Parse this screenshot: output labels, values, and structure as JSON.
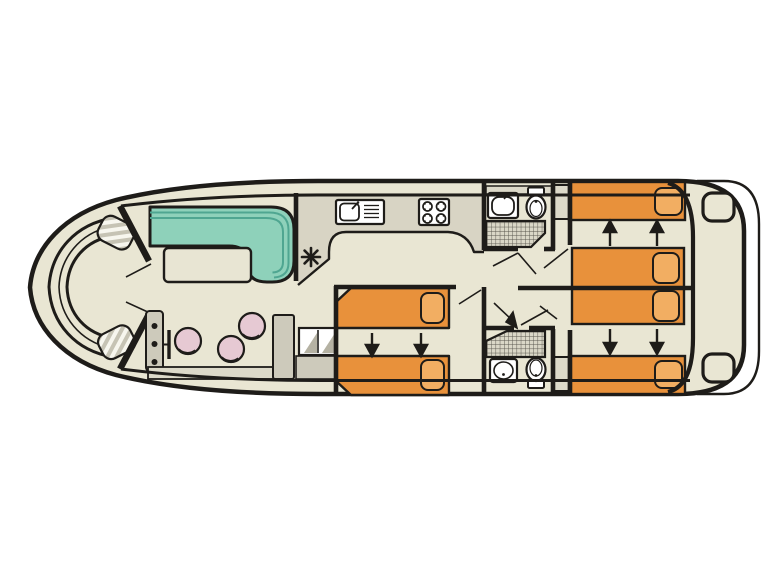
{
  "page": {
    "background": "#ffffff",
    "title": "houseboat-deck-plan"
  },
  "colors": {
    "outline": "#1e1c19",
    "floor": "#e9e6d3",
    "galley_floor": "#d8d4c4",
    "table": "#e8e5d3",
    "sofa": "#8ed1ba",
    "sofa_line": "#4fa691",
    "bed": "#e8913b",
    "pillow": "#f2ae62",
    "stool": "#e6c9d3",
    "gray": "#cdcabb",
    "gray_light": "#dcd9c9",
    "steps": "#b5b2a3",
    "fixture": "#ffffff",
    "hatch": "#55524a",
    "hatch_bg": "#dad7c7",
    "pad_stripe_a": "#c6c3b4",
    "pad_stripe_b": "#f7f6ee"
  },
  "plan": {
    "bow": {
      "seating": "c-shaped-bench",
      "fender_pads": 2,
      "entry_door_leaves": 2
    },
    "saloon": {
      "sofa_shape": "l-shaped",
      "tables": 1,
      "stools": 3,
      "helm_gauges": 3,
      "steering_wheel": 1,
      "sideboard": 1,
      "companionway_steps": 2
    },
    "galley": {
      "sinks": 1,
      "drainer_grooves": 4,
      "hob_burners": 4,
      "heater_symbol": "asterisk"
    },
    "bathrooms": [
      {
        "position": "forward",
        "washbasin": 1,
        "toilet": 1,
        "shower": "hatched-grid"
      },
      {
        "position": "aft",
        "washbasin": 1,
        "toilet": 1,
        "shower": "hatched-grid"
      }
    ],
    "cabins": [
      {
        "position": "midship-port",
        "beds": 2,
        "convert_arrows": "down",
        "arrow_count": 2
      },
      {
        "position": "aft-starboard",
        "beds": 2,
        "convert_arrows": "up",
        "arrow_count": 2
      },
      {
        "position": "aft-port",
        "beds": 2,
        "convert_arrows": "down",
        "arrow_count": 2
      }
    ],
    "wardrobes": 2,
    "stern": {
      "swim_platform": 1,
      "corner_steps": 2
    }
  }
}
